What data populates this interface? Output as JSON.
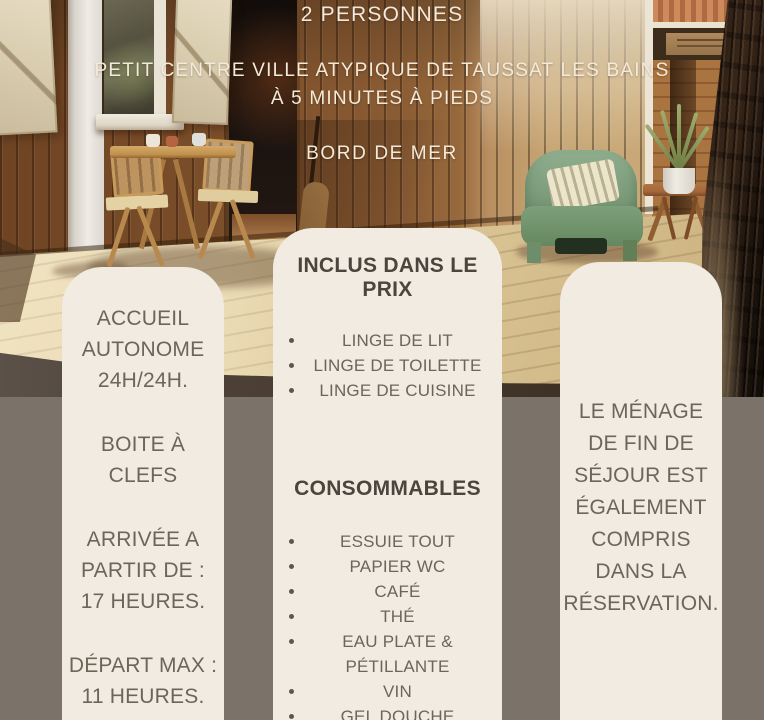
{
  "poster": {
    "header": {
      "capacity": "2 PERSONNES",
      "location_line1": "PETIT CENTRE VILLE ATYPIQUE DE TAUSSAT LES BAINS",
      "location_line2": "À 5 MINUTES À PIEDS",
      "seaside": "BORD DE MER"
    },
    "left_card": {
      "groups": [
        "ACCUEIL\nAUTONOME\n24H/24H.",
        "BOITE À\nCLEFS",
        "ARRIVÉE A\nPARTIR DE :\n17 HEURES.",
        "DÉPART MAX :\n11 HEURES."
      ]
    },
    "middle_card": {
      "included_heading": "INCLUS DANS LE PRIX",
      "included_items": [
        "LINGE DE LIT",
        "LINGE DE TOILETTE",
        "LINGE DE CUISINE"
      ],
      "consumables_heading": "CONSOMMABLES",
      "consumables_items": [
        "ESSUIE TOUT",
        "PAPIER WC",
        "CAFÉ",
        "THÉ",
        "EAU PLATE &\nPÉTILLANTE",
        "VIN",
        "GEL DOUCHE",
        "SHAMPOING"
      ]
    },
    "right_card": {
      "text": "LE MÉNAGE\nDE FIN DE\nSÉJOUR EST\nÉGALEMENT\nCOMPRIS\nDANS LA\nRÉSERVATION."
    },
    "colors": {
      "card_background": "#f2ebe1",
      "bottom_background": "#7b7269",
      "card_text": "#6d6559",
      "heading_text": "#4b463d",
      "header_text": "#f3ead9",
      "armchair_green": "#7a9a78"
    }
  }
}
